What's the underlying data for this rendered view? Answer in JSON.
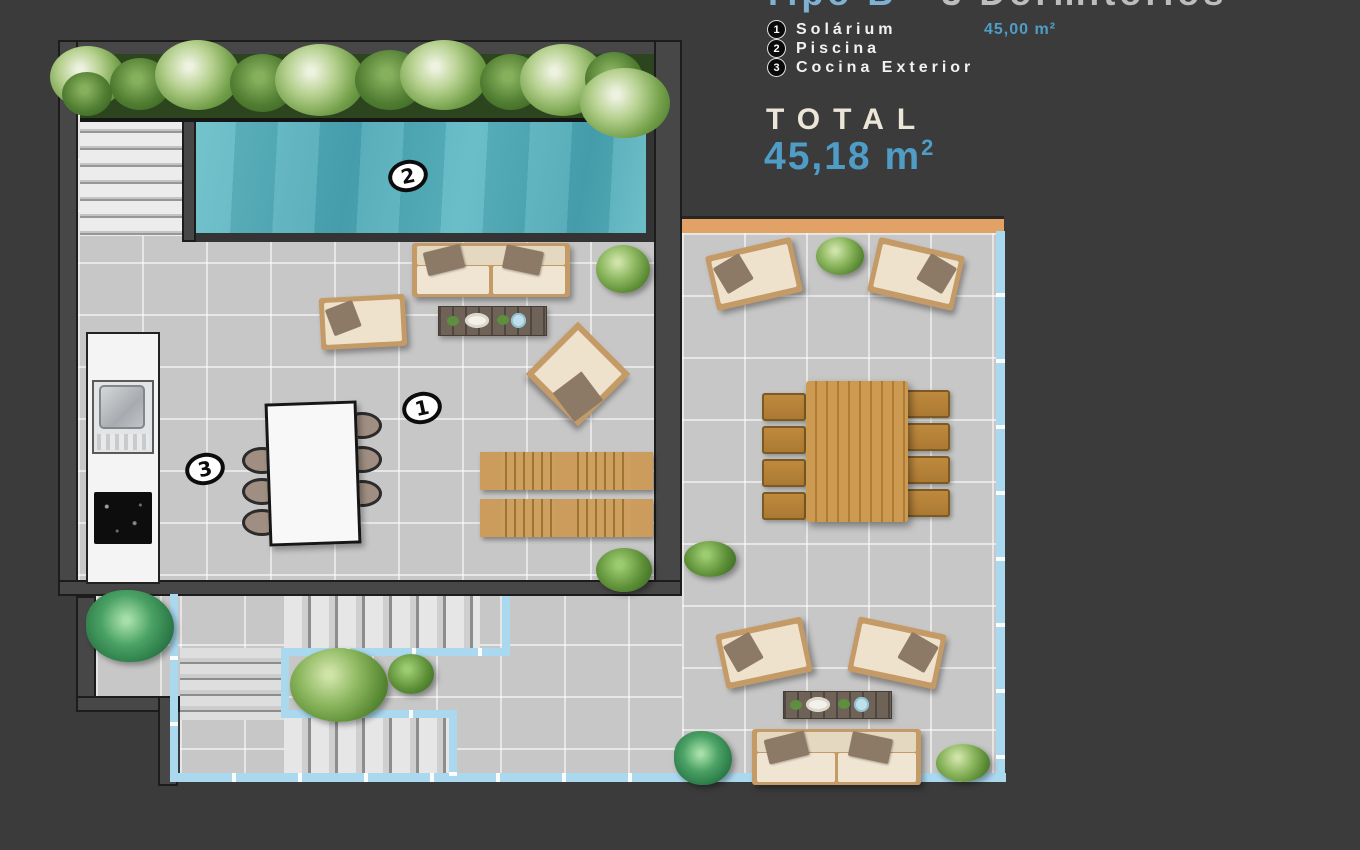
{
  "header": {
    "title_type": "Tipo B",
    "title_sep": "-",
    "title_rooms": "3 Dormitorios",
    "legend": [
      {
        "num": "1",
        "label": "Solárium",
        "value": "45,00 m²"
      },
      {
        "num": "2",
        "label": "Piscina",
        "value": ""
      },
      {
        "num": "3",
        "label": "Cocina Exterior",
        "value": ""
      }
    ],
    "total_label": "TOTAL",
    "total_value": "45,18",
    "total_unit": "m",
    "total_sup": "2"
  },
  "plan": {
    "badges": {
      "solarium": "1",
      "pool": "2",
      "kitchen": "3"
    }
  },
  "colors": {
    "background": "#3b3b3c",
    "accent_blue": "#4f9dc6",
    "title_blue": "#7fb2d2",
    "cream": "#ece6d8",
    "pool_water": "#55b1bd",
    "glass_railing": "#a9d8ef",
    "pergola_orange": "#e2a266",
    "tile": "#c7c7c7",
    "wood": "#c49a66"
  }
}
